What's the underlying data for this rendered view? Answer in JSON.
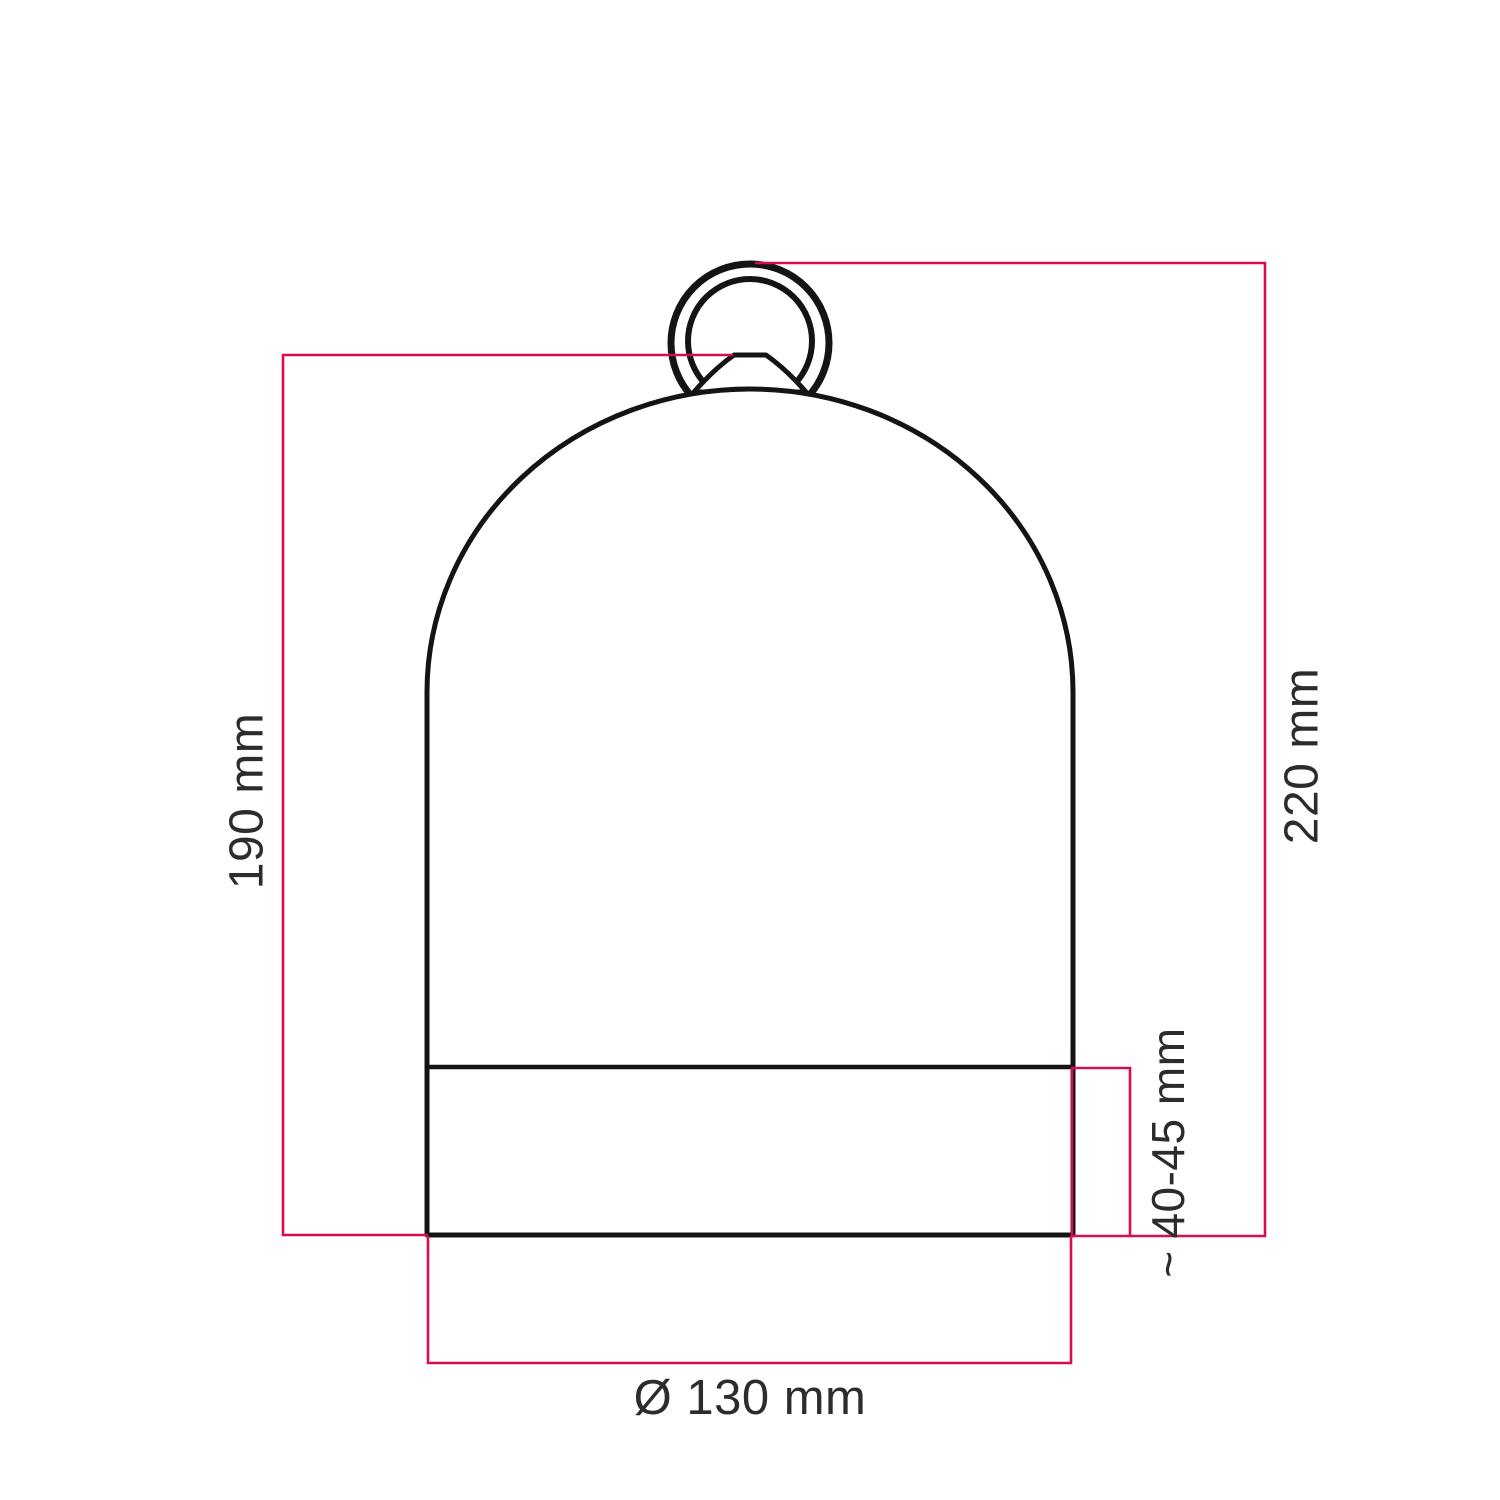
{
  "colors": {
    "dimension_red": "#d50f4b",
    "line_black": "#141414",
    "text_dark": "#2c2c2e",
    "background": "#ffffff"
  },
  "diagram": {
    "subject": "bell-shaped-lampshade-with-hanging-ring-dimension-drawing",
    "labels": {
      "shade_height": "190 mm",
      "total_height": "220 mm",
      "approx_symbol": "~",
      "base_height": "40-45 mm",
      "diameter": "Ø 130 mm"
    }
  }
}
